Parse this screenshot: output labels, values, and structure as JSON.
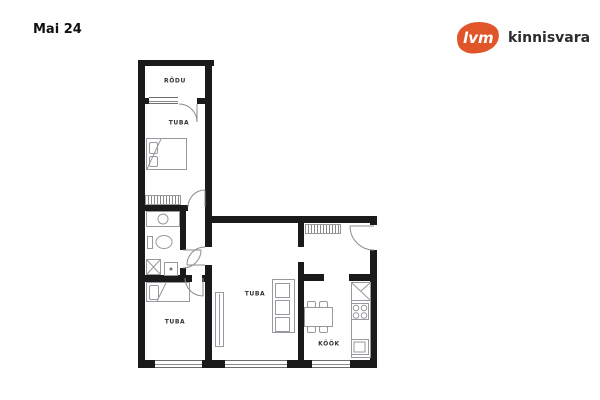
{
  "header": {
    "title": "Mai 24"
  },
  "logo": {
    "mark": "lvm",
    "name": "kinnisvara",
    "accent_color": "#e0562a",
    "name_color": "#2d2d2d"
  },
  "plan": {
    "wall_color": "#1a1a1a",
    "line_color": "#98989e",
    "rooms": [
      {
        "id": "rodu",
        "label": "RÕDU"
      },
      {
        "id": "tuba-top",
        "label": "TUBA"
      },
      {
        "id": "tuba-bottom",
        "label": "TUBA"
      },
      {
        "id": "tuba-living",
        "label": "TUBA"
      },
      {
        "id": "kook",
        "label": "KÖÖK"
      }
    ]
  }
}
